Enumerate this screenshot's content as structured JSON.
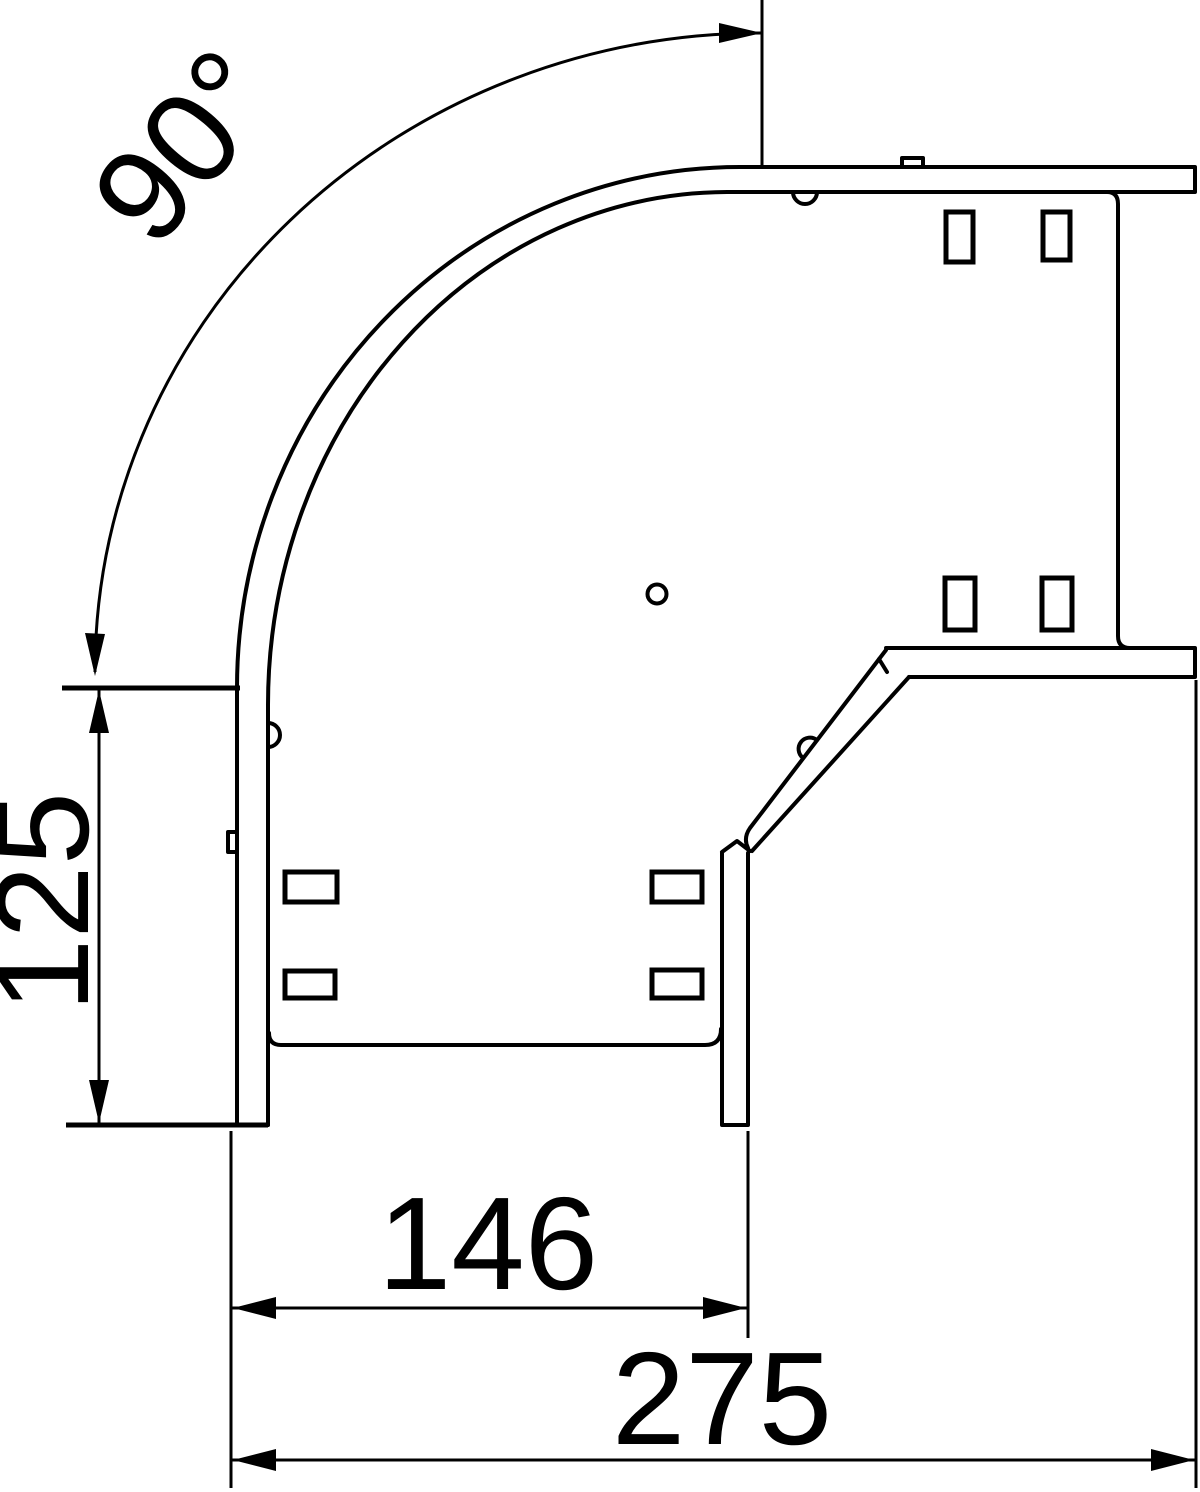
{
  "drawing": {
    "kind": "technical-dimension-drawing",
    "subject": "90-degree cable tray bend, plan view",
    "colors": {
      "line": "#000000",
      "background": "#ffffff"
    }
  },
  "dims": {
    "angle": "90°",
    "side_length": "125",
    "inner_width": "146",
    "overall_width": "275"
  }
}
